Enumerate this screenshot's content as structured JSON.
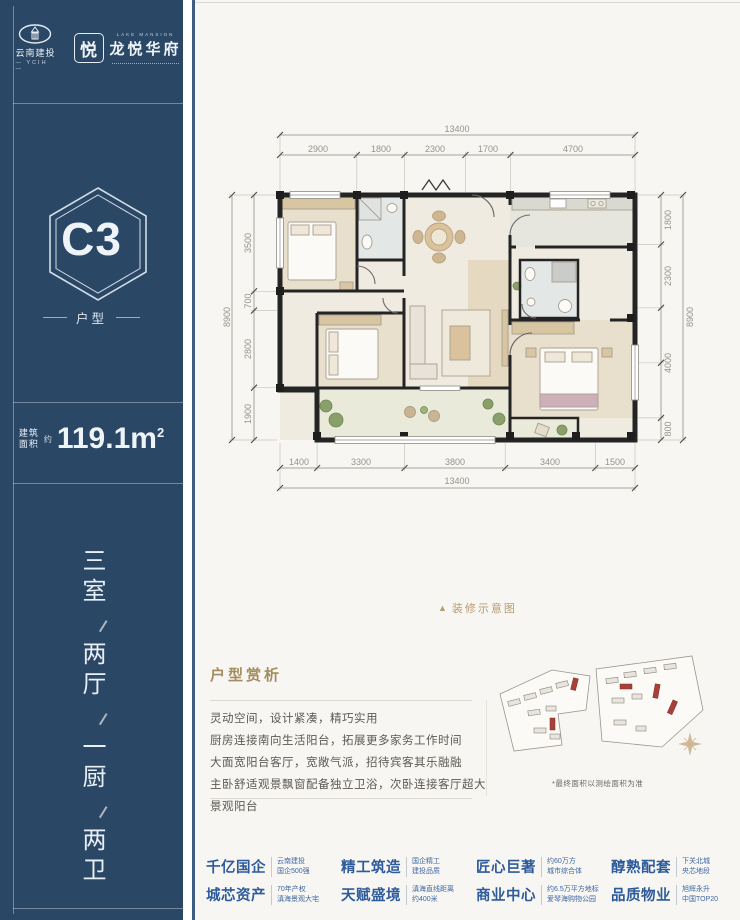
{
  "brand": {
    "developer_name": "云南建投",
    "developer_abbr": "— YCIH —",
    "project_mark": "悦",
    "project_en": "LAKE MANSION",
    "project_name": "龙悦华府"
  },
  "sidebar": {
    "unit_code": "C3",
    "unit_label": "户型",
    "area_label_top": "建筑",
    "area_label_bottom": "面积",
    "area_approx": "约",
    "area_value": "119.1m",
    "area_sup": "2",
    "layout": [
      "三室",
      "两厅",
      "一厨",
      "两卫"
    ]
  },
  "floorplan": {
    "caption_icon": "▲",
    "caption": "装修示意图",
    "dims": {
      "top_total": "13400",
      "top_segments": [
        "2900",
        "1800",
        "2300",
        "1700",
        "4700"
      ],
      "bottom_segments": [
        "1400",
        "3300",
        "3800",
        "3400",
        "1500"
      ],
      "bottom_total": "13400",
      "left_total": "8900",
      "left_segments": [
        "3500",
        "700",
        "2800",
        "1900"
      ],
      "right_segments": [
        "1800",
        "2300",
        "4000",
        "800"
      ],
      "right_total": "8900"
    }
  },
  "analysis": {
    "title": "户型赏析",
    "lines": [
      "灵动空间，设计紧凑，精巧实用",
      "厨房连接南向生活阳台，拓展更多家务工作时间",
      "大面宽阳台客厅，宽敞气派，招待宾客其乐融融",
      "主卧舒适观景飘窗配备独立卫浴，次卧连接客厅超大景观阳台"
    ]
  },
  "siteplan": {
    "note": "*最终面积以测绘面积为准"
  },
  "features": [
    {
      "label": "千亿国企",
      "sub1": "云南建投",
      "sub2": "国企500强"
    },
    {
      "label": "精工筑造",
      "sub1": "国企精工",
      "sub2": "建投品质"
    },
    {
      "label": "匠心巨著",
      "sub1": "约60万方",
      "sub2": "城市综合体"
    },
    {
      "label": "醇熟配套",
      "sub1": "下关北城",
      "sub2": "央芯地段"
    },
    {
      "label": "城芯资产",
      "sub1": "70年产权",
      "sub2": "滇海景观大宅"
    },
    {
      "label": "天赋盛境",
      "sub1": "滇海直线距离",
      "sub2": "约400米"
    },
    {
      "label": "商业中心",
      "sub1": "约6.5万平方地标",
      "sub2": "爱琴海购物公园"
    },
    {
      "label": "品质物业",
      "sub1": "旭辉永升",
      "sub2": "中国TOP20"
    }
  ]
}
